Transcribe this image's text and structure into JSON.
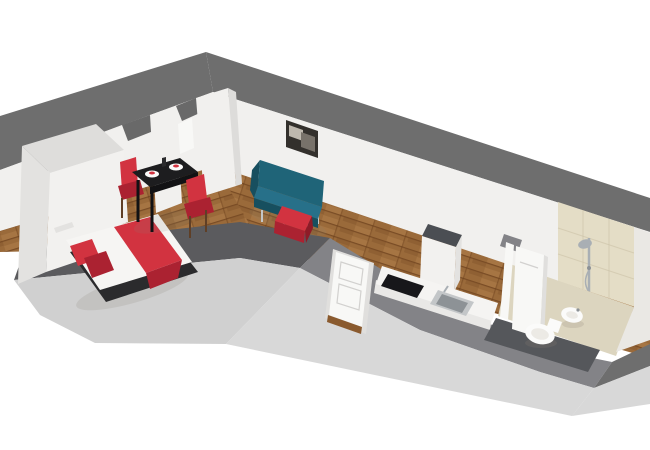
{
  "scene": {
    "kind": "3d-floorplan-render",
    "description": "Isometric dollhouse cutaway render of an L-shaped studio apartment on a white background",
    "rooms": [
      "bedroom-dining-wing",
      "living-kitchen-corridor",
      "bathroom",
      "closet-alcoves"
    ],
    "objects": [
      "wardrobe",
      "nightstand",
      "double-bed",
      "red-pillows",
      "red-blanket",
      "dining-table",
      "red-chair-left",
      "red-chair-right",
      "plates",
      "teal-sofa",
      "red-ottoman",
      "wall-picture",
      "fridge-cabinet",
      "kitchen-counter",
      "cooktop",
      "sink",
      "entry-door",
      "bathroom-door-open",
      "shower",
      "toilet",
      "bidet"
    ]
  },
  "colors": {
    "bg": "#ffffff",
    "farWallTop": "#6e6e6e",
    "nearLeftWallTop": "#5b5b5e",
    "nearRightWallTop": "#838387",
    "lintel": "#696969",
    "wallFace": "#f1f0ee",
    "wallFaceShade": "#dddcda",
    "outerFace": "#d0d0d0",
    "outerFaceRight": "#d8d8d8",
    "endWallFace": "#eae8e4",
    "woodBase": "#9a6a3a",
    "woodDark": "#7a4c24",
    "woodLight": "#b5824d",
    "woodSeam": "#6b3f1c",
    "tileFloor": "#dcd5bf",
    "tileWall": "#e4ddc6",
    "grout": "#cbc2a6",
    "bathBand": "#55575b",
    "sofa": "#1f6478",
    "sofaTop": "#277089",
    "sofaDark": "#174f5f",
    "red": "#d23340",
    "redDark": "#ab2231",
    "redDeep": "#8e1b27",
    "bedWhite": "#f6f5f3",
    "bedBase": "#2b2b2d",
    "tableBlack": "#1d1d1f",
    "tableEdge": "#121214",
    "legBrown": "#5f3f26",
    "plate": "#fbfbfa",
    "wardrobeTop": "#dedddb",
    "furnWhite": "#f2f1ef",
    "furnShade": "#e3e2e0",
    "fridgeTop": "#4b4e53",
    "counterWhite": "#f5f4f2",
    "counterFront": "#e9e8e6",
    "cooktop": "#17171a",
    "steel": "#c3c6c8",
    "steelDark": "#8d9296",
    "chrome": "#a9afb4",
    "doorWhite": "#f8f8f6",
    "doorShade": "#e0dfdd",
    "doorLine": "#d2d1cf",
    "fixtureWhite": "#fbfbfa",
    "fixtureShade": "#d8d5cd",
    "fixtureInner": "#eceae5",
    "shadow": "#8a8478",
    "pictureFrame": "#33302c",
    "pictureLight": "#beb8ae",
    "pictureMid": "#78726a",
    "thresholdWood": "#8a5a2e"
  }
}
